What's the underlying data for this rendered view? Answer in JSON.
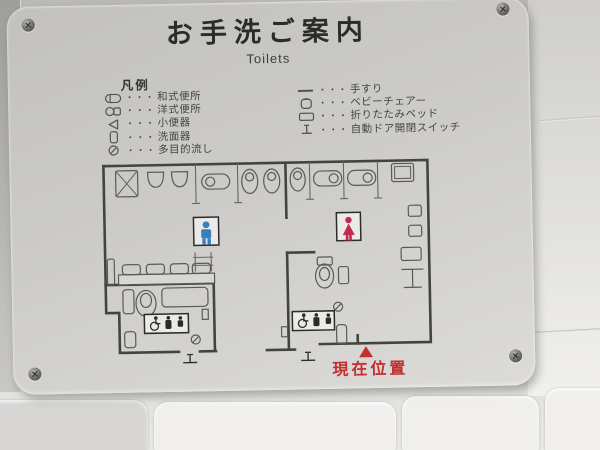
{
  "sign": {
    "title": "お手洗ご案内",
    "subtitle": "Toilets",
    "legend": {
      "heading": "凡例",
      "dots": "・・・",
      "left": [
        {
          "icon": "squat-toilet-icon",
          "label": "和式便所"
        },
        {
          "icon": "western-toilet-icon",
          "label": "洋式便所"
        },
        {
          "icon": "urinal-icon",
          "label": "小便器"
        },
        {
          "icon": "washbasin-icon",
          "label": "洗面器"
        },
        {
          "icon": "multipurpose-sink-icon",
          "label": "多目的流し"
        }
      ],
      "right": [
        {
          "icon": "handrail-icon",
          "label": "手すり"
        },
        {
          "icon": "baby-chair-icon",
          "label": "ベビーチェアー"
        },
        {
          "icon": "folding-bed-icon",
          "label": "折りたたみベッド"
        },
        {
          "icon": "auto-door-switch-icon",
          "label": "自動ドア開閉スイッチ"
        }
      ]
    },
    "map": {
      "mens_symbol": "men-pictogram",
      "womens_symbol": "women-pictogram",
      "accessible_symbols": "wheelchair-parent-baby-pictograms",
      "current_location_label": "現在位置"
    },
    "colors": {
      "mens_blue": "#3a7ec2",
      "womens_red": "#c42a50",
      "location_red": "#c22f2f",
      "plate_gray": "#cccbc9",
      "line_gray": "#44443f"
    }
  }
}
